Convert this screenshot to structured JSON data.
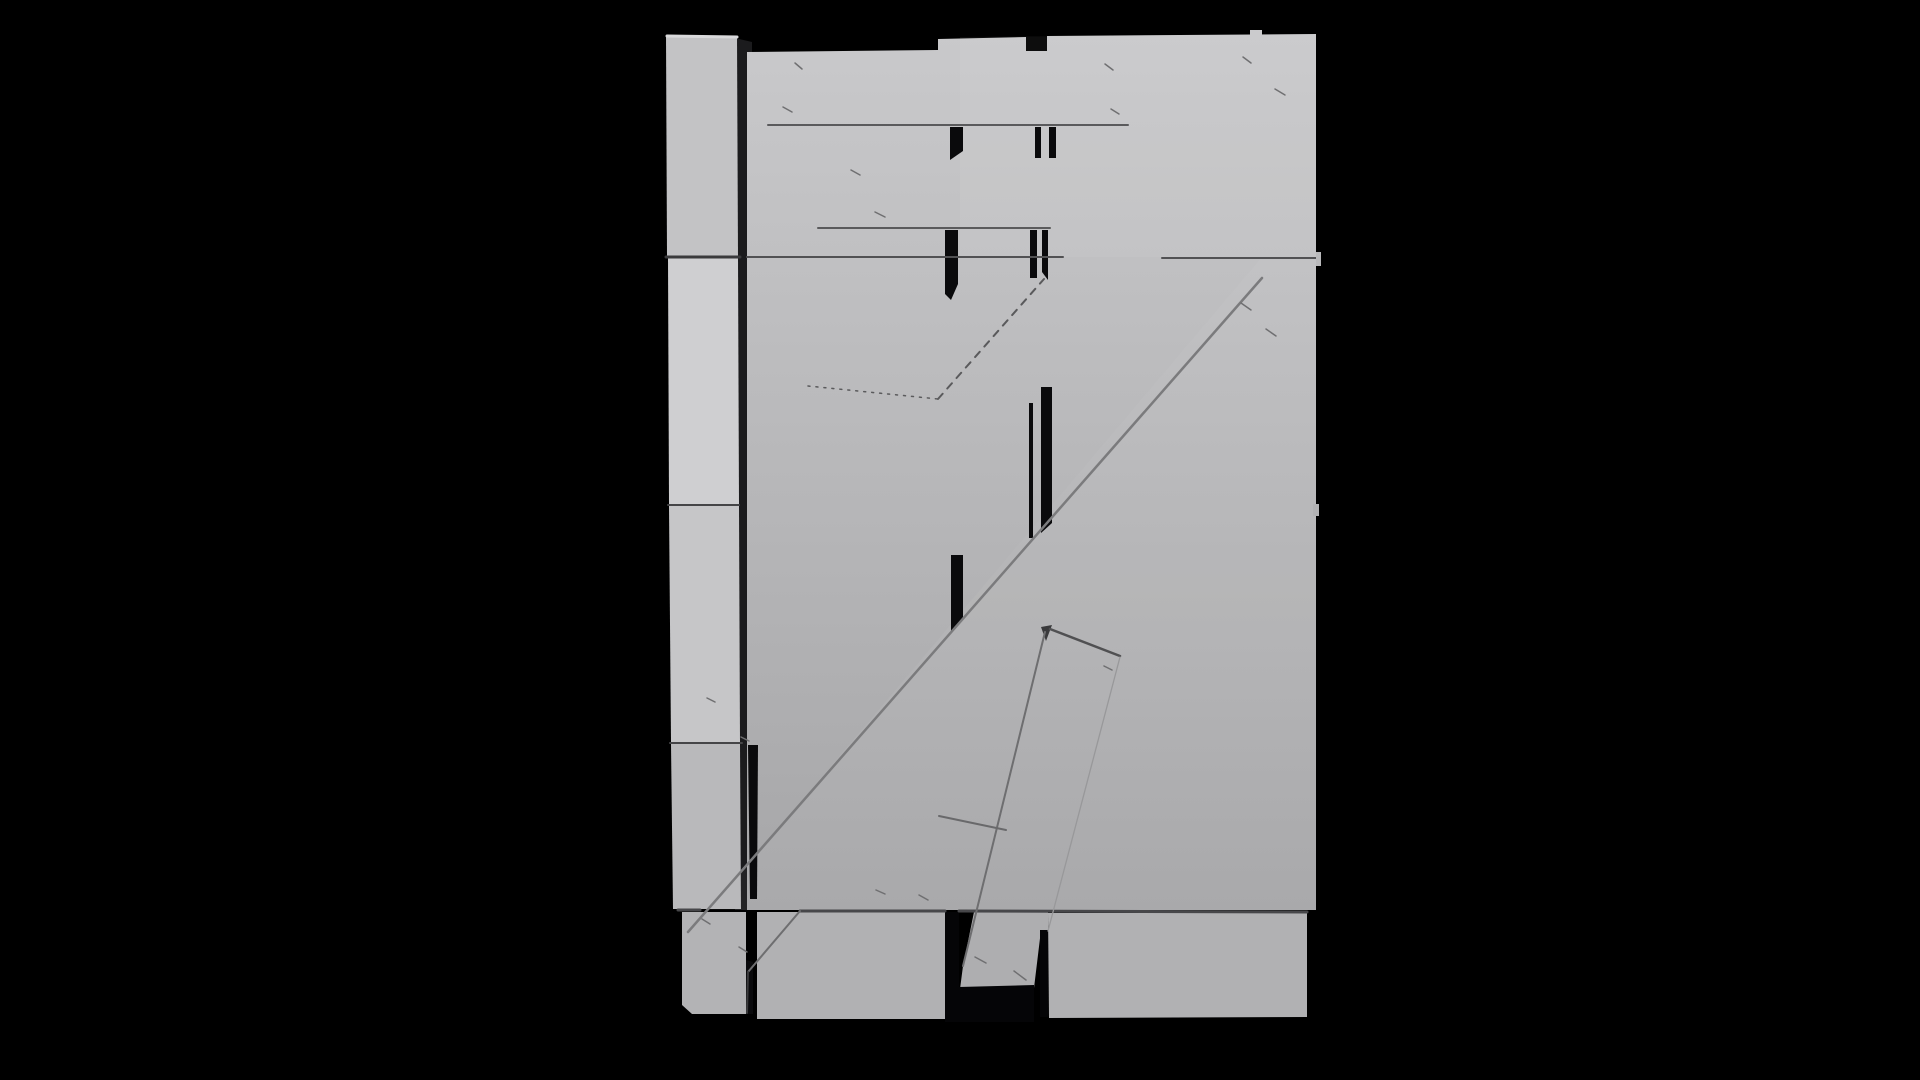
{
  "scene": {
    "name": "grayscale-3d-render-plank-door",
    "background": "#000000",
    "width": 1920,
    "height": 1080
  },
  "palette": {
    "background": "#000000",
    "panel_light": "#c9c9cb",
    "panel_dark": "#a6a6a8",
    "column_gray": "#c3c3c5",
    "column_light": "#cfcfd1",
    "bottom_plank": "#b1b1b3",
    "seam_dark": "#47474a",
    "seam_mid": "#5a5a5c",
    "slit_black": "#0a0a0c",
    "edge_line": "#7b7b7d"
  },
  "gradients": [
    {
      "id": "panelGrad",
      "from": "#c9c9cb",
      "to": "#a6a6a8"
    }
  ],
  "shapes": [
    {
      "kind": "polygon",
      "name": "column-gap-shadow",
      "points": "735,38 752,42 752,910 735,910",
      "fill": "#1b1b1d"
    },
    {
      "kind": "polygon",
      "name": "main-panel",
      "points": "747,52 938,50 938,39 1026,37 1026,51 1047,51 1047,36 1316,34 1316,910 747,910",
      "fill": "url(#panelGrad)"
    },
    {
      "kind": "polygon",
      "name": "top-right-plank-highlight",
      "points": "960,37 1316,34 1316,257 960,257",
      "fill": "#ffffff",
      "opacity": 0.05
    },
    {
      "kind": "polygon",
      "name": "brace-face-highlight",
      "points": "1262,257 1316,257 1316,910 709,910",
      "fill": "#ffffff",
      "opacity": 0.04
    },
    {
      "kind": "polygon",
      "name": "column-segment-1",
      "points": "666,35 737,36 738,256 667,256",
      "fill": "#c3c3c5"
    },
    {
      "kind": "line",
      "name": "column-top-bevel",
      "x1": 667,
      "y1": 36,
      "x2": 737,
      "y2": 37,
      "stroke": "#d9d9db",
      "sw": 3
    },
    {
      "kind": "polygon",
      "name": "column-segment-2",
      "points": "668,258 738,258 739,504 669,504",
      "fill": "#cfcfd1"
    },
    {
      "kind": "polygon",
      "name": "column-segment-3",
      "points": "669,506 739,506 740,742 671,742",
      "fill": "#c6c6c8"
    },
    {
      "kind": "polygon",
      "name": "column-segment-4",
      "points": "671,744 740,744 741,909 673,909",
      "fill": "#b9b9bb"
    },
    {
      "kind": "polygon",
      "name": "bottom-plank-left",
      "points": "682,912 746,912 746,1014 692,1014 682,1005",
      "fill": "#b3b3b5"
    },
    {
      "kind": "polygon",
      "name": "bottom-plank-mid",
      "points": "757,912 945,912 945,1019 757,1019",
      "fill": "#b1b1b3"
    },
    {
      "kind": "polygon",
      "name": "diag-brace-bottom",
      "points": "974,912 1048,912 1048,930 1041,930 1034,988 960,989 963,966",
      "fill": "#aeaeb0"
    },
    {
      "kind": "polygon",
      "name": "bottom-plank-right",
      "points": "1048,913 1307,913 1307,1017 1049,1018",
      "fill": "#b1b1b3"
    },
    {
      "kind": "polygon",
      "name": "plank-slit",
      "points": "950,127 963,127 963,151 950,160",
      "fill": "#0a0a0c"
    },
    {
      "kind": "rect",
      "name": "plank-slit",
      "x": 1035,
      "y": 127,
      "w": 6,
      "h": 31,
      "fill": "#0a0a0c"
    },
    {
      "kind": "rect",
      "name": "plank-slit",
      "x": 1049,
      "y": 127,
      "w": 7,
      "h": 31,
      "fill": "#0a0a0c"
    },
    {
      "kind": "polygon",
      "name": "plank-slit",
      "points": "945,230 958,230 958,284 951,300 945,294",
      "fill": "#0a0a0c"
    },
    {
      "kind": "rect",
      "name": "plank-slit",
      "x": 1030,
      "y": 230,
      "w": 7,
      "h": 48,
      "fill": "#0a0a0c"
    },
    {
      "kind": "polygon",
      "name": "plank-slit",
      "points": "1042,230 1048,230 1048,280 1042,272",
      "fill": "#0a0a0c"
    },
    {
      "kind": "rect",
      "name": "plank-slit",
      "x": 1029,
      "y": 403,
      "w": 4,
      "h": 135,
      "fill": "#0a0a0c"
    },
    {
      "kind": "polygon",
      "name": "plank-slit",
      "points": "1041,387 1052,387 1052,523 1041,533",
      "fill": "#0a0a0c"
    },
    {
      "kind": "polygon",
      "name": "plank-slit",
      "points": "951,555 963,555 963,620 951,632",
      "fill": "#0a0a0c"
    },
    {
      "kind": "polygon",
      "name": "plank-slit",
      "points": "748,745 758,745 757,899 750,899",
      "fill": "#0a0a0c"
    },
    {
      "kind": "polygon",
      "name": "plank-slit",
      "points": "746,960 753,962 753,1014 746,1014",
      "fill": "#0a0a0c"
    },
    {
      "kind": "rect",
      "name": "plank-slit",
      "x": 945,
      "y": 912,
      "w": 14,
      "h": 110,
      "fill": "#050507"
    },
    {
      "kind": "polygon",
      "name": "brace-underside-shadow",
      "points": "959,987 1034,985 1034,1022 959,1022",
      "fill": "#050507"
    },
    {
      "kind": "rect",
      "name": "plank-slit",
      "x": 1040,
      "y": 930,
      "w": 8,
      "h": 87,
      "fill": "#050507"
    },
    {
      "kind": "line",
      "name": "plank-seam",
      "x1": 768,
      "y1": 125,
      "x2": 1128,
      "y2": 125,
      "stroke": "#5a5a5c",
      "sw": 2
    },
    {
      "kind": "line",
      "name": "plank-seam",
      "x1": 818,
      "y1": 228,
      "x2": 1050,
      "y2": 228,
      "stroke": "#5a5a5c",
      "sw": 2
    },
    {
      "kind": "line",
      "name": "plank-seam",
      "x1": 666,
      "y1": 257,
      "x2": 740,
      "y2": 257,
      "stroke": "#3a3a3c",
      "sw": 3
    },
    {
      "kind": "line",
      "name": "plank-seam",
      "x1": 747,
      "y1": 257,
      "x2": 1063,
      "y2": 257,
      "stroke": "#515153",
      "sw": 2
    },
    {
      "kind": "line",
      "name": "plank-seam",
      "x1": 1162,
      "y1": 258,
      "x2": 1316,
      "y2": 258,
      "stroke": "#515153",
      "sw": 2
    },
    {
      "kind": "line",
      "name": "plank-seam",
      "x1": 668,
      "y1": 505,
      "x2": 739,
      "y2": 505,
      "stroke": "#454547",
      "sw": 2
    },
    {
      "kind": "line",
      "name": "plank-seam",
      "x1": 670,
      "y1": 743,
      "x2": 742,
      "y2": 743,
      "stroke": "#454547",
      "sw": 2
    },
    {
      "kind": "line",
      "name": "plank-seam",
      "x1": 678,
      "y1": 910,
      "x2": 700,
      "y2": 910,
      "stroke": "#47474a",
      "sw": 3
    },
    {
      "kind": "line",
      "name": "plank-seam",
      "x1": 800,
      "y1": 911,
      "x2": 945,
      "y2": 911,
      "stroke": "#47474a",
      "sw": 3
    },
    {
      "kind": "line",
      "name": "plank-seam",
      "x1": 959,
      "y1": 911,
      "x2": 1307,
      "y2": 912,
      "stroke": "#47474a",
      "sw": 3
    },
    {
      "kind": "line",
      "name": "diag-brace-edge",
      "x1": 1262,
      "y1": 278,
      "x2": 688,
      "y2": 932,
      "stroke": "#7b7b7d",
      "sw": 2.5
    },
    {
      "kind": "line",
      "name": "diag-brace-lower-edge",
      "x1": 800,
      "y1": 911,
      "x2": 748,
      "y2": 972,
      "stroke": "#6e6e70",
      "sw": 2
    },
    {
      "kind": "line",
      "name": "diag-brace-end-edge",
      "x1": 748,
      "y1": 972,
      "x2": 747,
      "y2": 1013,
      "stroke": "#3a3a3c",
      "sw": 2
    },
    {
      "kind": "polygon",
      "name": "narrow-brace-tip",
      "points": "1041,627 1052,625 1046,641",
      "fill": "#3a3a3c"
    },
    {
      "kind": "line",
      "name": "narrow-brace-left-edge",
      "x1": 1045,
      "y1": 632,
      "x2": 963,
      "y2": 966,
      "stroke": "#6e6e70",
      "sw": 2
    },
    {
      "kind": "line",
      "name": "narrow-brace-top-edge",
      "x1": 1050,
      "y1": 629,
      "x2": 1120,
      "y2": 656,
      "stroke": "#505052",
      "sw": 2.5
    },
    {
      "kind": "line",
      "name": "narrow-brace-right-edge",
      "x1": 1120,
      "y1": 657,
      "x2": 1048,
      "y2": 931,
      "stroke": "#98989a",
      "sw": 1.3
    },
    {
      "kind": "line",
      "name": "artifact-dotted-line",
      "x1": 808,
      "y1": 386,
      "x2": 938,
      "y2": 399,
      "stroke": "#5a5a5c",
      "sw": 1.5,
      "dash": "2,6"
    },
    {
      "kind": "line",
      "name": "artifact-dashed-line",
      "x1": 938,
      "y1": 399,
      "x2": 1044,
      "y2": 279,
      "stroke": "#5a5a5c",
      "sw": 2,
      "dash": "7,7"
    },
    {
      "kind": "line",
      "name": "plank-end-cut-line",
      "x1": 939,
      "y1": 816,
      "x2": 1006,
      "y2": 830,
      "stroke": "#69696b",
      "sw": 2
    },
    {
      "kind": "rect",
      "name": "right-edge-tab",
      "x": 1316,
      "y": 252,
      "w": 5,
      "h": 14,
      "fill": "#b9b9bb"
    },
    {
      "kind": "rect",
      "name": "right-edge-tab",
      "x": 1313,
      "y": 504,
      "w": 6,
      "h": 12,
      "fill": "#b2b2b4"
    },
    {
      "kind": "rect",
      "name": "top-edge-bump",
      "x": 1250,
      "y": 30,
      "w": 12,
      "h": 6,
      "fill": "#cbcbcd"
    },
    {
      "kind": "line",
      "name": "scratch-mark",
      "x1": 795,
      "y1": 63,
      "x2": 802,
      "y2": 69,
      "stroke": "#6f6f71",
      "sw": 1.5
    },
    {
      "kind": "line",
      "name": "scratch-mark",
      "x1": 783,
      "y1": 107,
      "x2": 792,
      "y2": 112,
      "stroke": "#6f6f71",
      "sw": 1.5
    },
    {
      "kind": "line",
      "name": "scratch-mark",
      "x1": 851,
      "y1": 170,
      "x2": 860,
      "y2": 175,
      "stroke": "#6f6f71",
      "sw": 1.5
    },
    {
      "kind": "line",
      "name": "scratch-mark",
      "x1": 875,
      "y1": 212,
      "x2": 885,
      "y2": 217,
      "stroke": "#6f6f71",
      "sw": 1.5
    },
    {
      "kind": "line",
      "name": "scratch-mark",
      "x1": 1105,
      "y1": 64,
      "x2": 1113,
      "y2": 70,
      "stroke": "#6f6f71",
      "sw": 1.5
    },
    {
      "kind": "line",
      "name": "scratch-mark",
      "x1": 1111,
      "y1": 109,
      "x2": 1119,
      "y2": 114,
      "stroke": "#6f6f71",
      "sw": 1.5
    },
    {
      "kind": "line",
      "name": "scratch-mark",
      "x1": 1243,
      "y1": 57,
      "x2": 1251,
      "y2": 63,
      "stroke": "#6f6f71",
      "sw": 1.5
    },
    {
      "kind": "line",
      "name": "scratch-mark",
      "x1": 1275,
      "y1": 89,
      "x2": 1285,
      "y2": 95,
      "stroke": "#6f6f71",
      "sw": 1.5
    },
    {
      "kind": "line",
      "name": "scratch-mark",
      "x1": 1241,
      "y1": 303,
      "x2": 1251,
      "y2": 310,
      "stroke": "#6f6f71",
      "sw": 1.5
    },
    {
      "kind": "line",
      "name": "scratch-mark",
      "x1": 1266,
      "y1": 329,
      "x2": 1276,
      "y2": 336,
      "stroke": "#6f6f71",
      "sw": 1.5
    },
    {
      "kind": "line",
      "name": "scratch-mark",
      "x1": 975,
      "y1": 957,
      "x2": 986,
      "y2": 963,
      "stroke": "#6f6f71",
      "sw": 1.5
    },
    {
      "kind": "line",
      "name": "scratch-mark",
      "x1": 1014,
      "y1": 971,
      "x2": 1026,
      "y2": 980,
      "stroke": "#6f6f71",
      "sw": 1.5
    },
    {
      "kind": "line",
      "name": "scratch-mark",
      "x1": 702,
      "y1": 919,
      "x2": 710,
      "y2": 924,
      "stroke": "#6f6f71",
      "sw": 1.5
    },
    {
      "kind": "line",
      "name": "scratch-mark",
      "x1": 739,
      "y1": 947,
      "x2": 747,
      "y2": 952,
      "stroke": "#6f6f71",
      "sw": 1.5
    },
    {
      "kind": "line",
      "name": "scratch-mark",
      "x1": 876,
      "y1": 890,
      "x2": 885,
      "y2": 894,
      "stroke": "#6f6f71",
      "sw": 1.5
    },
    {
      "kind": "line",
      "name": "scratch-mark",
      "x1": 919,
      "y1": 895,
      "x2": 928,
      "y2": 900,
      "stroke": "#6f6f71",
      "sw": 1.5
    },
    {
      "kind": "line",
      "name": "scratch-mark",
      "x1": 1104,
      "y1": 666,
      "x2": 1112,
      "y2": 670,
      "stroke": "#6f6f71",
      "sw": 1.5
    },
    {
      "kind": "line",
      "name": "scratch-mark",
      "x1": 707,
      "y1": 698,
      "x2": 715,
      "y2": 702,
      "stroke": "#6f6f71",
      "sw": 1.5
    },
    {
      "kind": "line",
      "name": "scratch-mark",
      "x1": 741,
      "y1": 737,
      "x2": 749,
      "y2": 741,
      "stroke": "#6f6f71",
      "sw": 1.5
    }
  ]
}
